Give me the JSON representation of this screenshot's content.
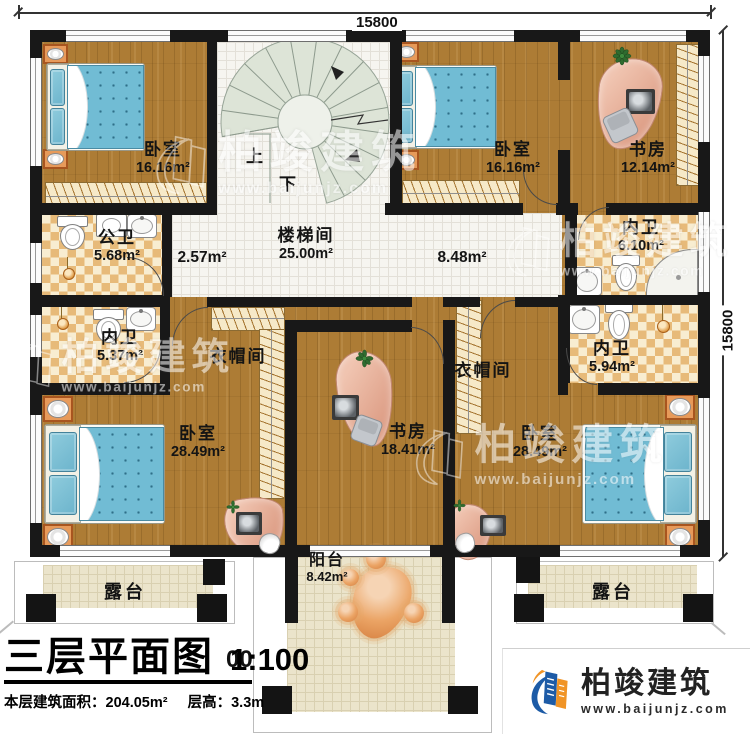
{
  "title_block": {
    "title": "三层平面图",
    "scale": "1:100",
    "area_line": "本层建筑面积：204.05m²",
    "height_line": "层高：3.3m"
  },
  "brand": {
    "name": "柏竣建筑",
    "website": "www.baijunjz.com"
  },
  "watermark": {
    "name": "柏竣建筑",
    "website": "www.baijunjz.com"
  },
  "dimensions": {
    "top": "15800",
    "right": "15800",
    "bottom_partial": "00"
  },
  "stairs": {
    "up_label": "上",
    "down_label": "下"
  },
  "rooms": {
    "bedroom_tl": {
      "name": "卧室",
      "area": "16.16m²"
    },
    "bedroom_tr": {
      "name": "卧室",
      "area": "16.16m²"
    },
    "study_tr": {
      "name": "书房",
      "area": "12.14m²"
    },
    "public_bath": {
      "name": "公卫",
      "area": "5.68m²"
    },
    "stair_hall": {
      "name": "楼梯间",
      "area": "25.00m²"
    },
    "vestibule": {
      "area": "2.57m²"
    },
    "corridor": {
      "area": "8.48m²"
    },
    "inner_bath_tr": {
      "name": "内卫",
      "area": "6.10m²"
    },
    "inner_bath_left": {
      "name": "内卫",
      "area": "5.37m²"
    },
    "inner_bath_br": {
      "name": "内卫",
      "area": "5.94m²"
    },
    "cloakroom_left": {
      "name": "衣帽间"
    },
    "cloakroom_right": {
      "name": "衣帽间"
    },
    "bedroom_bl": {
      "name": "卧室",
      "area": "28.49m²"
    },
    "study_center": {
      "name": "书房",
      "area": "18.41m²"
    },
    "bedroom_br": {
      "name": "卧室",
      "area": "28.49m²"
    },
    "balcony": {
      "name": "阳台",
      "area": "8.42m²"
    },
    "terrace_left": {
      "name": "露台"
    },
    "terrace_right": {
      "name": "露台"
    }
  },
  "colors": {
    "wall": "#181818",
    "wood_floor": "#ad7c35",
    "bath_tile": "#e7ba79",
    "hall_tile": "#f6f5f0",
    "stair": "#dde4d7",
    "balcony_tile": "#ebe4cb",
    "bed": "#71bcd4",
    "nightstand": "#e79a5a",
    "desk_pad": "#e8b09a",
    "brand_blue": "#1d5ba6",
    "brand_orange": "#f09426"
  }
}
